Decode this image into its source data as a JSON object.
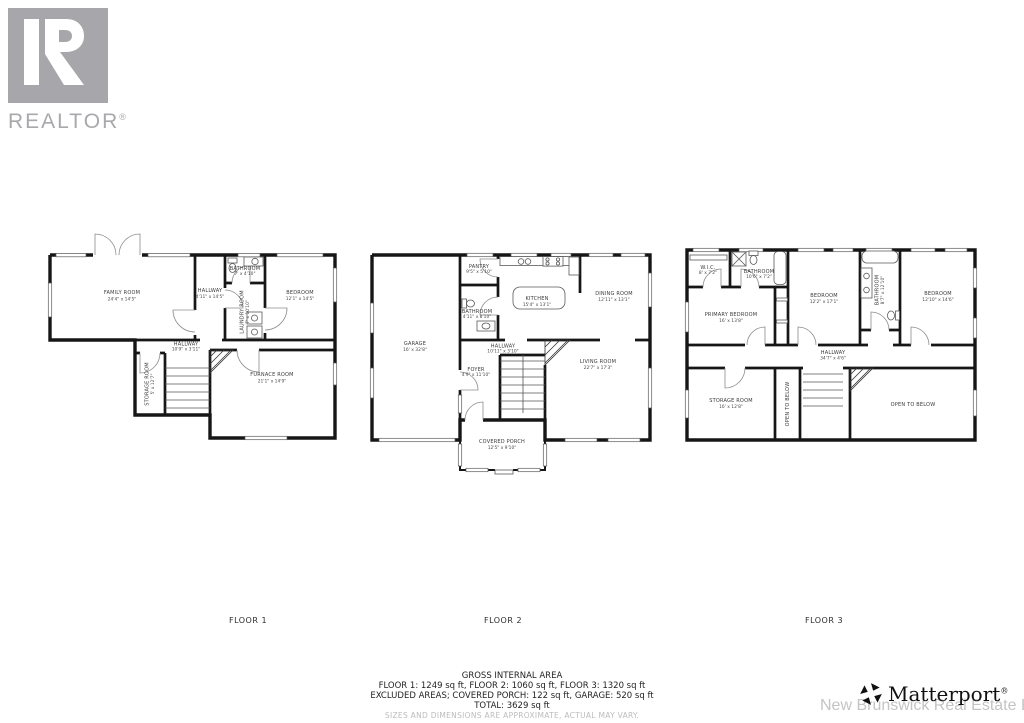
{
  "branding": {
    "realtor": {
      "text": "REALTOR",
      "reg": "®"
    },
    "matterport": {
      "text": "Matterport",
      "reg": "®"
    },
    "watermark": "New Brunswick Real Estate Board"
  },
  "colors": {
    "wall": "#161616",
    "room_label": "#3a3a3a",
    "watermark_gray": "#c4c4c4",
    "realtor_gray": "#a7a7ab",
    "matterport_black": "#111111"
  },
  "floors": [
    {
      "label": "FLOOR 1",
      "rooms": [
        {
          "name": "FAMILY ROOM",
          "dims": "24'4\" x 14'5\""
        },
        {
          "name": "HALLWAY",
          "dims": "4'11\" x 14'5\""
        },
        {
          "name": "BATHROOM",
          "dims": "7' x 4'10\""
        },
        {
          "name": "LAUNDRY ROOM",
          "dims": "7' x 10'10\""
        },
        {
          "name": "BEDROOM",
          "dims": "12'1\" x 14'5\""
        },
        {
          "name": "HALLWAY",
          "dims": "10'9\" x 3'11\""
        },
        {
          "name": "STORAGE ROOM",
          "dims": "5' x 12'7\""
        },
        {
          "name": "FURNACE ROOM",
          "dims": "21'1\" x 14'9\""
        }
      ]
    },
    {
      "label": "FLOOR 2",
      "rooms": [
        {
          "name": "PANTRY",
          "dims": "9'5\" x 5'10\""
        },
        {
          "name": "BATHROOM",
          "dims": "4'11\" x 8'10\""
        },
        {
          "name": "KITCHEN",
          "dims": "15'4\" x 13'1\""
        },
        {
          "name": "DINING ROOM",
          "dims": "12'11\" x 13'1\""
        },
        {
          "name": "GARAGE",
          "dims": "16' x 32'8\""
        },
        {
          "name": "HALLWAY",
          "dims": "10'11\" x 3'10\""
        },
        {
          "name": "FOYER",
          "dims": "4'9\" x 11'10\""
        },
        {
          "name": "LIVING ROOM",
          "dims": "22'7\" x 17'3\""
        },
        {
          "name": "COVERED PORCH",
          "dims": "12'5\" x 9'10\""
        }
      ]
    },
    {
      "label": "FLOOR 3",
      "rooms": [
        {
          "name": "W.I.C.",
          "dims": "8' x 7'2\""
        },
        {
          "name": "BATHROOM",
          "dims": "10'6\" x 7'2\""
        },
        {
          "name": "PRIMARY BEDROOM",
          "dims": "16' x 13'8\""
        },
        {
          "name": "BEDROOM",
          "dims": "12'2\" x 17'1\""
        },
        {
          "name": "BATHROOM",
          "dims": "8'7\" x 12'10\""
        },
        {
          "name": "BEDROOM",
          "dims": "12'10\" x 14'6\""
        },
        {
          "name": "HALLWAY",
          "dims": "34'7\" x 4'6\""
        },
        {
          "name": "STORAGE ROOM",
          "dims": "16' x 12'8\""
        },
        {
          "name": "OPEN TO BELOW",
          "dims": ""
        },
        {
          "name": "OPEN TO BELOW",
          "dims": ""
        }
      ]
    }
  ],
  "summary": {
    "title": "GROSS INTERNAL AREA",
    "floor_areas": "FLOOR 1: 1249 sq ft, FLOOR 2: 1060 sq ft, FLOOR 3: 1320 sq ft",
    "excluded": "EXCLUDED AREAS; COVERED PORCH: 122 sq ft, GARAGE: 520 sq ft",
    "total": "TOTAL: 3629 sq ft",
    "disclaimer": "SIZES AND DIMENSIONS ARE APPROXIMATE, ACTUAL MAY VARY."
  }
}
